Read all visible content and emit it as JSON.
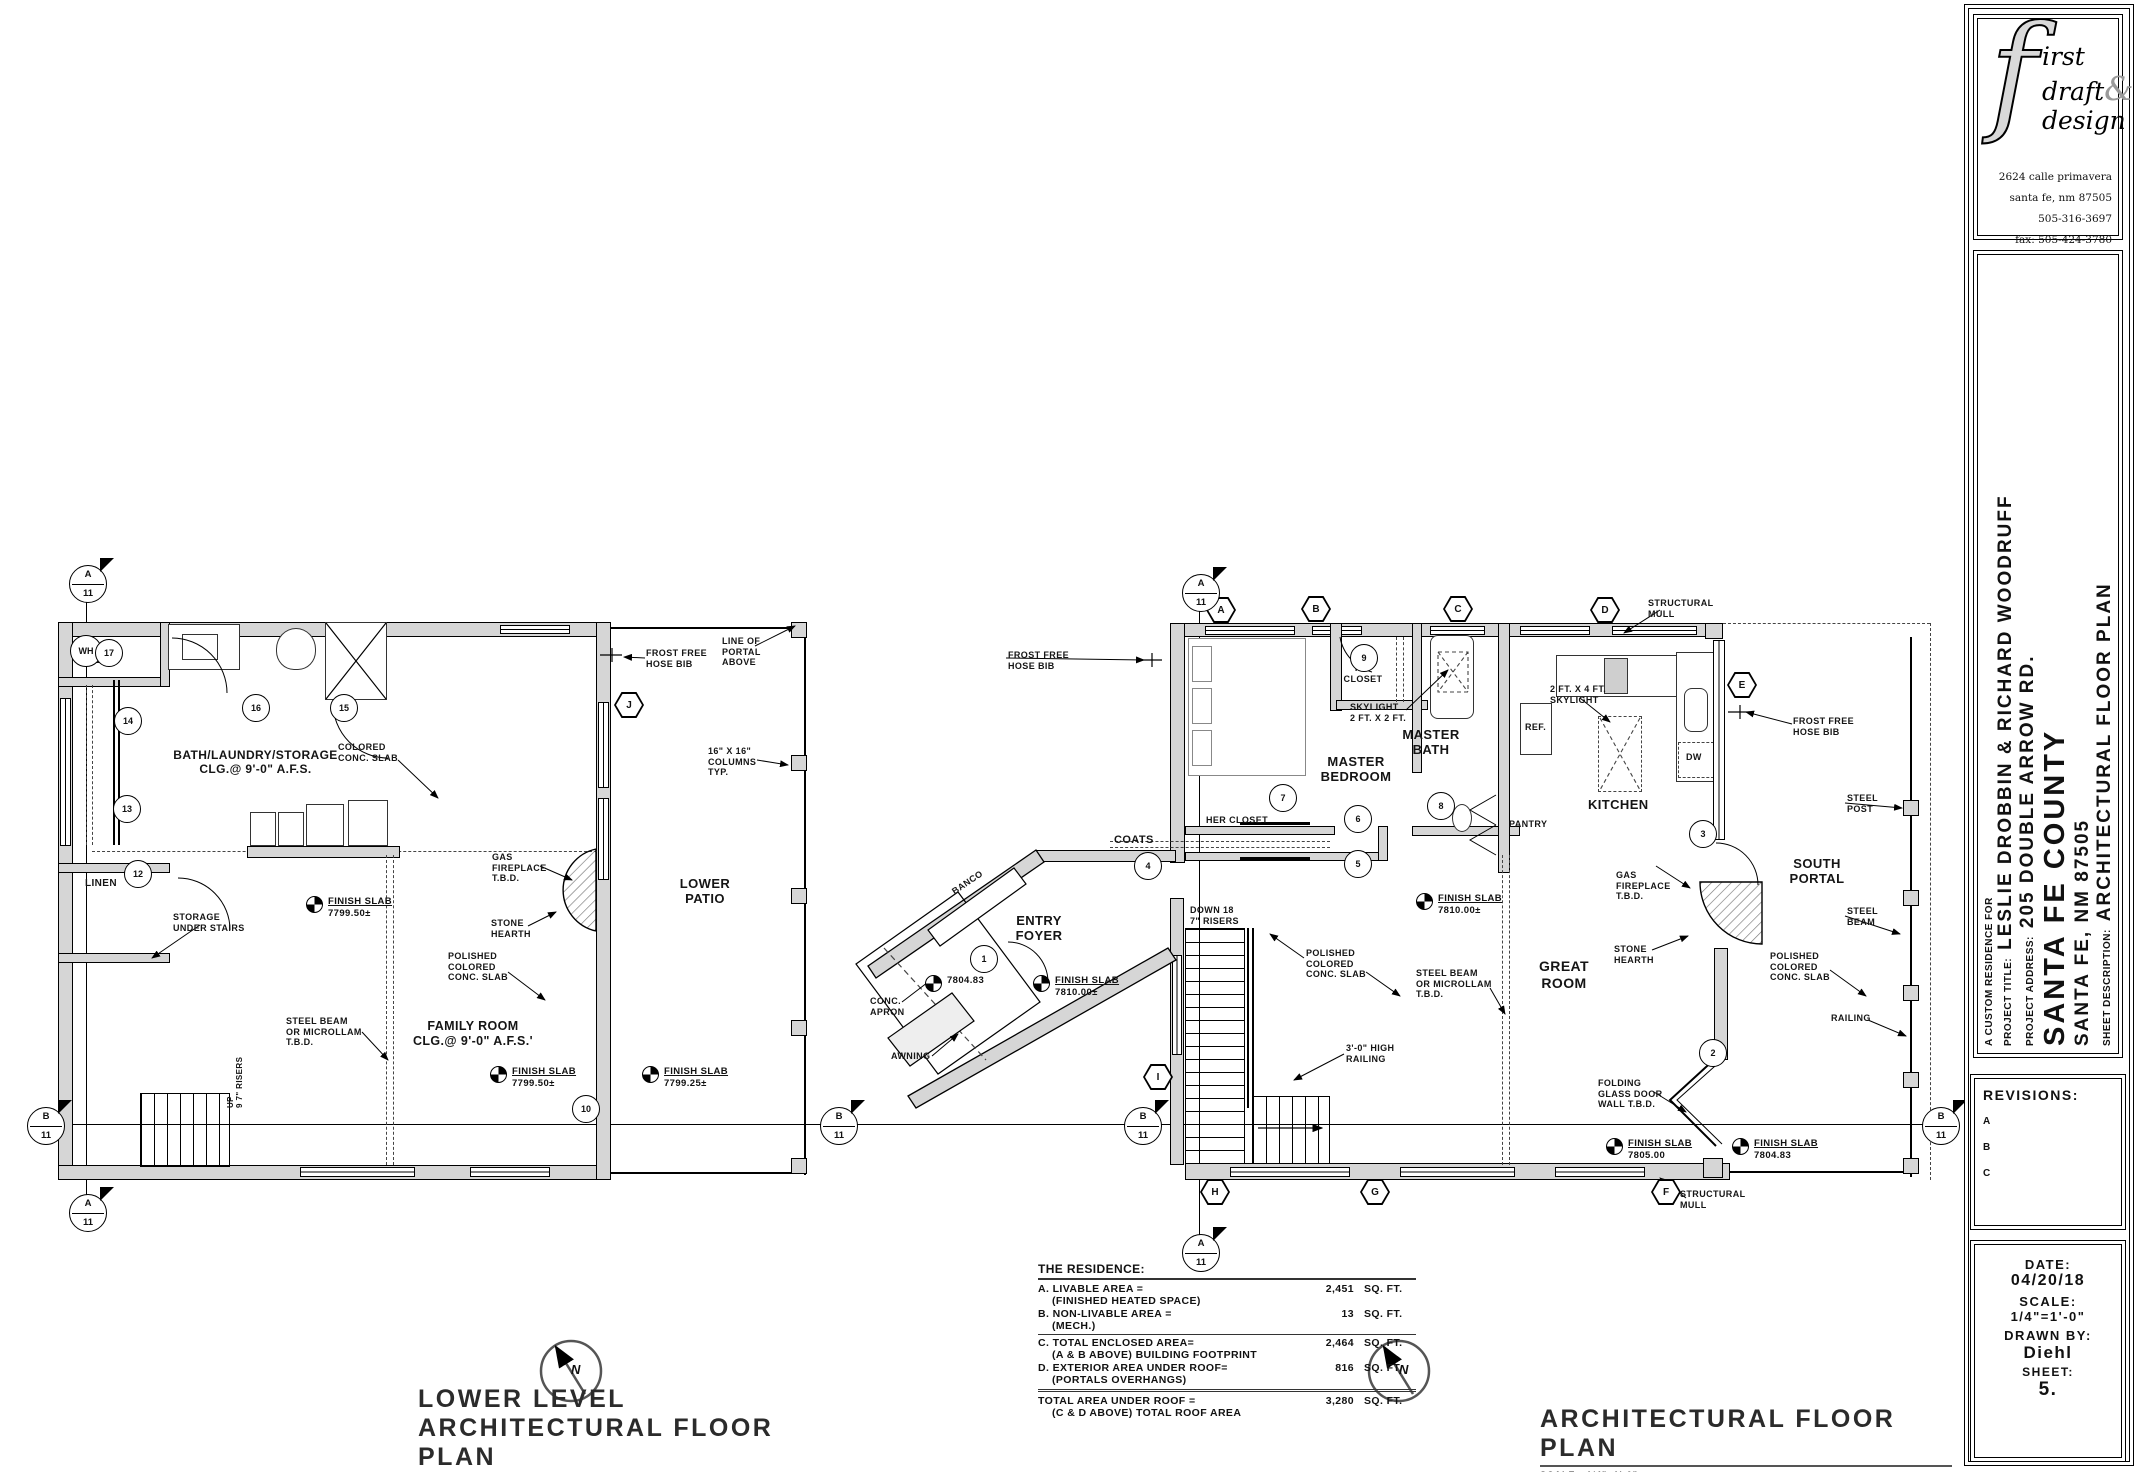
{
  "firm": {
    "logo_f": "f",
    "logo_word1": "irst",
    "logo_word2": "draft",
    "logo_amp": "&",
    "logo_word3": "design",
    "address": [
      "2624 calle primavera",
      "santa fe, nm 87505",
      "505-316-3697",
      "fax: 505-424-3780",
      "diehlbeasley@gmail.com"
    ]
  },
  "project": {
    "custom": "A CUSTOM RESIDENCE FOR",
    "title_label": "PROJECT TITLE:",
    "title": "LESLIE DROBBIN & RICHARD WOODRUFF",
    "address_label": "PROJECT ADDRESS:",
    "address1": "205 DOUBLE ARROW RD.",
    "address2": "SANTA FE COUNTY",
    "address3": "SANTA FE, NM 87505",
    "sheet_label": "SHEET DESCRIPTION:",
    "sheet_desc": "ARCHITECTURAL FLOOR PLAN"
  },
  "revisions": {
    "label": "REVISIONS:",
    "items": [
      "A",
      "B",
      "C"
    ]
  },
  "info": {
    "date_label": "DATE:",
    "date": "04/20/18",
    "scale_label": "SCALE:",
    "scale": "1/4\"=1'-0\"",
    "drawn_label": "DRAWN BY:",
    "drawn": "Diehl",
    "sheet_label": "SHEET:",
    "sheet": "5."
  },
  "titles": {
    "lower": {
      "line1": "LOWER LEVEL",
      "line2": "ARCHITECTURAL FLOOR PLAN",
      "scale_label": "SCALE:",
      "scale": "1/4\"=1'-0\""
    },
    "main": {
      "line2": "ARCHITECTURAL FLOOR PLAN",
      "scale_label": "SCALE:",
      "scale": "1/4\"=1'-0\""
    }
  },
  "compass": {
    "n": "N"
  },
  "area_table": {
    "title": "THE RESIDENCE:",
    "rows": [
      {
        "label": "A. LIVABLE AREA =",
        "sub": "(FINISHED HEATED SPACE)",
        "value": "2,451",
        "unit": "SQ. FT."
      },
      {
        "label": "B. NON-LIVABLE AREA =",
        "sub": "(MECH.)",
        "value": "13",
        "unit": "SQ. FT."
      },
      {
        "label": "C. TOTAL ENCLOSED AREA=",
        "sub": "(A & B ABOVE) BUILDING FOOTPRINT",
        "value": "2,464",
        "unit": "SQ. FT.",
        "rule": "single"
      },
      {
        "label": "D. EXTERIOR AREA UNDER ROOF=",
        "sub": "(PORTALS OVERHANGS)",
        "value": "816",
        "unit": "SQ. FT."
      },
      {
        "label": "TOTAL AREA UNDER ROOF =",
        "sub": "(C & D ABOVE) TOTAL ROOF AREA",
        "value": "3,280",
        "unit": "SQ. FT.",
        "rule": "double"
      }
    ]
  },
  "labels": [
    {
      "t": "MECH.",
      "x": 86,
      "y": 655,
      "fs": 10,
      "n": "room-label-mech"
    },
    {
      "t": "BATH/LAUNDRY/STORAGE\nCLG.@ 9'-0\" A.F.S.",
      "x": 158,
      "y": 748,
      "fs": 12,
      "al": "center",
      "w": 195,
      "n": "room-label-bath-laundry-storage"
    },
    {
      "t": "LINEN",
      "x": 85,
      "y": 878,
      "fs": 10,
      "n": "room-label-linen"
    },
    {
      "t": "STORAGE\nUNDER STAIRS",
      "x": 173,
      "y": 912,
      "fs": 9
    },
    {
      "t": "COLORED\nCONC. SLAB",
      "x": 338,
      "y": 742,
      "fs": 9
    },
    {
      "t": "GAS\nFIREPLACE\nT.B.D.",
      "x": 492,
      "y": 852,
      "fs": 9
    },
    {
      "t": "STONE\nHEARTH",
      "x": 491,
      "y": 918,
      "fs": 9
    },
    {
      "t": "POLISHED\nCOLORED\nCONC. SLAB",
      "x": 448,
      "y": 951,
      "fs": 9
    },
    {
      "t": "STEEL BEAM\nOR MICROLLAM\nT.B.D.",
      "x": 286,
      "y": 1016,
      "fs": 9
    },
    {
      "t": "FAMILY ROOM\nCLG.@ 9'-0\" A.F.S.'",
      "x": 398,
      "y": 1019,
      "fs": 12.5,
      "al": "center",
      "w": 150,
      "n": "room-label-family-room"
    },
    {
      "t": "FROST FREE\nHOSE BIB",
      "x": 646,
      "y": 648,
      "fs": 9
    },
    {
      "t": "LINE OF\nPORTAL\nABOVE",
      "x": 722,
      "y": 636,
      "fs": 9
    },
    {
      "t": "16\" X 16\"\nCOLUMNS\nTYP.",
      "x": 708,
      "y": 746,
      "fs": 9
    },
    {
      "t": "LOWER\nPATIO",
      "x": 663,
      "y": 876,
      "fs": 13,
      "al": "center",
      "w": 84,
      "n": "room-label-lower-patio"
    },
    {
      "t": "UP\n9 7\" RISERS",
      "x": 226,
      "y": 1108,
      "fs": 8,
      "rot": -90
    },
    {
      "t": "FROST FREE\nHOSE BIB",
      "x": 1008,
      "y": 650,
      "fs": 9
    },
    {
      "t": "HIS\nCLOSET",
      "x": 1338,
      "y": 663,
      "fs": 9,
      "al": "center",
      "w": 50,
      "n": "room-label-his-closet"
    },
    {
      "t": "SKYLIGHT\n2 FT. X 2 FT.",
      "x": 1350,
      "y": 702,
      "fs": 9
    },
    {
      "t": "MASTER\nBATH",
      "x": 1394,
      "y": 727,
      "fs": 13,
      "al": "center",
      "w": 74,
      "n": "room-label-master-bath"
    },
    {
      "t": "MASTER\nBEDROOM",
      "x": 1306,
      "y": 754,
      "fs": 13,
      "al": "center",
      "w": 100,
      "n": "room-label-master-bedroom"
    },
    {
      "t": "HER CLOSET",
      "x": 1206,
      "y": 815,
      "fs": 9,
      "n": "room-label-her-closet"
    },
    {
      "t": "COATS",
      "x": 1114,
      "y": 834,
      "fs": 11,
      "n": "room-label-coats"
    },
    {
      "t": "STRUCTURAL\nMULL",
      "x": 1648,
      "y": 598,
      "fs": 9
    },
    {
      "t": "2 FT. X 4 FT.\nSKYLIGHT",
      "x": 1550,
      "y": 684,
      "fs": 9
    },
    {
      "t": "REF.",
      "x": 1525,
      "y": 722,
      "fs": 9
    },
    {
      "t": "DW",
      "x": 1686,
      "y": 752,
      "fs": 9
    },
    {
      "t": "KITCHEN",
      "x": 1588,
      "y": 797,
      "fs": 13,
      "n": "room-label-kitchen"
    },
    {
      "t": "PANTRY",
      "x": 1509,
      "y": 819,
      "fs": 9,
      "n": "room-label-pantry"
    },
    {
      "t": "FROST FREE\nHOSE BIB",
      "x": 1793,
      "y": 716,
      "fs": 9
    },
    {
      "t": "SOUTH\nPORTAL",
      "x": 1780,
      "y": 856,
      "fs": 13,
      "al": "center",
      "w": 74,
      "n": "room-label-south-portal"
    },
    {
      "t": "STEEL\nPOST",
      "x": 1847,
      "y": 793,
      "fs": 9
    },
    {
      "t": "STEEL\nBEAM",
      "x": 1847,
      "y": 906,
      "fs": 9
    },
    {
      "t": "GAS\nFIREPLACE\nT.B.D.",
      "x": 1616,
      "y": 870,
      "fs": 9
    },
    {
      "t": "STONE\nHEARTH",
      "x": 1614,
      "y": 944,
      "fs": 9
    },
    {
      "t": "POLISHED\nCOLORED\nCONC. SLAB",
      "x": 1306,
      "y": 948,
      "fs": 9
    },
    {
      "t": "STEEL BEAM\nOR MICROLLAM\nT.B.D.",
      "x": 1416,
      "y": 968,
      "fs": 9
    },
    {
      "t": "GREAT\nROOM",
      "x": 1522,
      "y": 958,
      "fs": 14,
      "al": "center",
      "w": 84,
      "n": "room-label-great-room"
    },
    {
      "t": "DOWN 18\n7\" RISERS",
      "x": 1190,
      "y": 905,
      "fs": 9
    },
    {
      "t": "POLISHED\nCOLORED\nCONC. SLAB",
      "x": 1770,
      "y": 951,
      "fs": 9
    },
    {
      "t": "RAILING",
      "x": 1831,
      "y": 1013,
      "fs": 9
    },
    {
      "t": "3'-0\" HIGH\nRAILING",
      "x": 1346,
      "y": 1043,
      "fs": 9
    },
    {
      "t": "FOLDING\nGLASS DOOR\nWALL T.B.D.",
      "x": 1598,
      "y": 1078,
      "fs": 9
    },
    {
      "t": "STRUCTURAL\nMULL",
      "x": 1680,
      "y": 1189,
      "fs": 9
    },
    {
      "t": "ENTRY\nFOYER",
      "x": 1002,
      "y": 913,
      "fs": 13,
      "al": "center",
      "w": 74,
      "n": "room-label-entry-foyer"
    },
    {
      "t": "BANCO",
      "x": 950,
      "y": 888,
      "fs": 9,
      "rot": -34,
      "n": "banco-label"
    },
    {
      "t": "CONC.\nAPRON",
      "x": 870,
      "y": 996,
      "fs": 9
    },
    {
      "t": "AWNING",
      "x": 891,
      "y": 1051,
      "fs": 9
    }
  ],
  "benchmarks": [
    {
      "x": 306,
      "y": 896,
      "l1": "FINISH SLAB",
      "l2": "7799.50±"
    },
    {
      "x": 490,
      "y": 1066,
      "l1": "FINISH SLAB",
      "l2": "7799.50±"
    },
    {
      "x": 642,
      "y": 1066,
      "l1": "FINISH SLAB",
      "l2": "7799.25±"
    },
    {
      "x": 1416,
      "y": 893,
      "l1": "FINISH SLAB",
      "l2": "7810.00±"
    },
    {
      "x": 1606,
      "y": 1138,
      "l1": "FINISH SLAB",
      "l2": "7805.00"
    },
    {
      "x": 1732,
      "y": 1138,
      "l1": "FINISH SLAB",
      "l2": "7804.83"
    },
    {
      "x": 925,
      "y": 975,
      "l2": "7804.83"
    },
    {
      "x": 1033,
      "y": 975,
      "l1": "FINISH SLAB",
      "l2": "7810.00±"
    }
  ],
  "circles": [
    {
      "t": "WH",
      "x": 85,
      "y": 650,
      "r": 15
    },
    {
      "t": "17",
      "x": 108,
      "y": 652,
      "r": 13
    },
    {
      "t": "16",
      "x": 255,
      "y": 707,
      "r": 13
    },
    {
      "t": "15",
      "x": 343,
      "y": 707,
      "r": 13
    },
    {
      "t": "14",
      "x": 127,
      "y": 720,
      "r": 13
    },
    {
      "t": "13",
      "x": 126,
      "y": 808,
      "r": 13
    },
    {
      "t": "12",
      "x": 137,
      "y": 873,
      "r": 13
    },
    {
      "t": "10",
      "x": 585,
      "y": 1108,
      "r": 13
    },
    {
      "t": "1",
      "x": 983,
      "y": 958,
      "r": 13
    },
    {
      "t": "2",
      "x": 1712,
      "y": 1052,
      "r": 13
    },
    {
      "t": "3",
      "x": 1702,
      "y": 833,
      "r": 13
    },
    {
      "t": "4",
      "x": 1147,
      "y": 865,
      "r": 13
    },
    {
      "t": "5",
      "x": 1357,
      "y": 863,
      "r": 13
    },
    {
      "t": "6",
      "x": 1357,
      "y": 818,
      "r": 13
    },
    {
      "t": "7",
      "x": 1282,
      "y": 797,
      "r": 13
    },
    {
      "t": "8",
      "x": 1440,
      "y": 805,
      "r": 13
    },
    {
      "t": "9",
      "x": 1363,
      "y": 657,
      "r": 13
    }
  ],
  "hexes": [
    {
      "t": "J",
      "x": 629,
      "y": 705
    },
    {
      "t": "A",
      "x": 1221,
      "y": 610
    },
    {
      "t": "B",
      "x": 1316,
      "y": 609
    },
    {
      "t": "C",
      "x": 1458,
      "y": 609
    },
    {
      "t": "D",
      "x": 1605,
      "y": 610
    },
    {
      "t": "E",
      "x": 1742,
      "y": 685
    },
    {
      "t": "I",
      "x": 1158,
      "y": 1077
    },
    {
      "t": "H",
      "x": 1215,
      "y": 1192
    },
    {
      "t": "G",
      "x": 1375,
      "y": 1192
    },
    {
      "t": "F",
      "x": 1666,
      "y": 1192
    }
  ],
  "sections": [
    {
      "l": "A",
      "n": "11",
      "x": 87,
      "y": 583
    },
    {
      "l": "A",
      "n": "11",
      "x": 87,
      "y": 1212
    },
    {
      "l": "B",
      "n": "11",
      "x": 45,
      "y": 1125
    },
    {
      "l": "B",
      "n": "11",
      "x": 838,
      "y": 1125
    },
    {
      "l": "A",
      "n": "11",
      "x": 1200,
      "y": 592
    },
    {
      "l": "A",
      "n": "11",
      "x": 1200,
      "y": 1252
    },
    {
      "l": "B",
      "n": "11",
      "x": 1142,
      "y": 1125
    },
    {
      "l": "B",
      "n": "11",
      "x": 1940,
      "y": 1125
    }
  ]
}
